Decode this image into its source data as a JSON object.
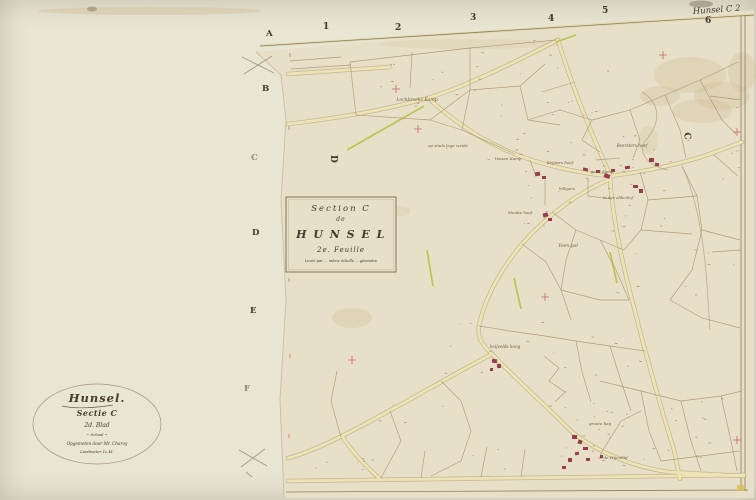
{
  "colors": {
    "paper_backing": "#e9e5d3",
    "paper_sheet": "#e7dfc8",
    "ink_dark": "#3f3629",
    "ink_brown": "#8a7554",
    "parcel_line": "#a6916a",
    "road_fill": "#ece3b6",
    "road_edge": "#b5a577",
    "hedge_green": "#b4bf3b",
    "building_red": "#8e2f44",
    "mark_red": "#c4544b",
    "stain": "#cdb98e"
  },
  "sheet": {
    "corner_label": "Hunsel C 2",
    "grid_numbers": [
      {
        "label": "1",
        "x": 323,
        "y": 29
      },
      {
        "label": "2",
        "x": 395,
        "y": 30
      },
      {
        "label": "3",
        "x": 470,
        "y": 20
      },
      {
        "label": "4",
        "x": 548,
        "y": 21
      },
      {
        "label": "5",
        "x": 602,
        "y": 13
      },
      {
        "label": "6",
        "x": 705,
        "y": 23
      }
    ],
    "row_letters": [
      {
        "label": "A",
        "x": 266,
        "y": 36,
        "o": 1
      },
      {
        "label": "B",
        "x": 262,
        "y": 91,
        "o": 1
      },
      {
        "label": "C",
        "x": 251,
        "y": 160,
        "o": 0.5
      },
      {
        "label": "D",
        "x": 252,
        "y": 235,
        "o": 1
      },
      {
        "label": "E",
        "x": 250,
        "y": 313,
        "o": 1
      },
      {
        "label": "F",
        "x": 244,
        "y": 391,
        "o": 0.55
      }
    ],
    "adjacent_letters": [
      {
        "label": "D",
        "x": 331,
        "y": 155,
        "rot": 90
      },
      {
        "label": "C",
        "x": 684,
        "y": 133,
        "rot": 80
      }
    ]
  },
  "cartouche": {
    "lines": [
      {
        "text": "Section C",
        "dy": 211,
        "size": 8.5,
        "style": "italic",
        "weight": "normal",
        "ls": 2
      },
      {
        "text": "de",
        "dy": 221,
        "size": 6,
        "style": "italic",
        "weight": "normal",
        "ls": 1
      },
      {
        "text": "H U N S E L",
        "dy": 238,
        "size": 11,
        "style": "normal",
        "weight": "bold",
        "ls": 1.5
      },
      {
        "text": "2e. Feuille",
        "dy": 252,
        "size": 7,
        "style": "italic",
        "weight": "normal",
        "ls": 1
      },
      {
        "text": "Levée par … même échelle … géomètre",
        "dy": 262,
        "size": 3.6,
        "style": "italic",
        "weight": "normal",
        "ls": 0
      }
    ]
  },
  "stamp": {
    "lines": [
      {
        "text": "Hunsel.",
        "dy": 402,
        "size": 11.5,
        "style": "italic",
        "weight": "bold",
        "ls": 1
      },
      {
        "text": "Sectie C",
        "dy": 416,
        "size": 8,
        "style": "italic",
        "weight": "bold",
        "ls": 0.5
      },
      {
        "text": "2d. Blad",
        "dy": 427,
        "size": 6,
        "style": "italic",
        "weight": "normal",
        "ls": 0
      },
      {
        "text": "~ Schaal ~",
        "dy": 436,
        "size": 3.8,
        "style": "italic",
        "weight": "normal",
        "ls": 0
      },
      {
        "text": "Opgemeten door Mr. Charoy",
        "dy": 445,
        "size": 4.2,
        "style": "italic",
        "weight": "normal",
        "ls": 0
      },
      {
        "text": "Landmeter 1e Kl.",
        "dy": 453,
        "size": 3.8,
        "style": "italic",
        "weight": "normal",
        "ls": 0
      }
    ]
  },
  "field_labels": [
    {
      "text": "Lochbroeks Kamp",
      "x": 417,
      "y": 101,
      "size": 4.5
    },
    {
      "text": "op stads lage weide",
      "x": 448,
      "y": 147,
      "size": 4
    },
    {
      "text": "Vossen Kamp",
      "x": 508,
      "y": 160,
      "size": 4
    },
    {
      "text": "Keijsers hoef",
      "x": 560,
      "y": 164,
      "size": 4
    },
    {
      "text": "hilligers",
      "x": 567,
      "y": 190,
      "size": 3.8
    },
    {
      "text": "Beersters hoef",
      "x": 632,
      "y": 147,
      "size": 4.2
    },
    {
      "text": "geert Kamp",
      "x": 602,
      "y": 173,
      "size": 3.8
    },
    {
      "text": "in den aldenhof",
      "x": 618,
      "y": 199,
      "size": 3.8
    },
    {
      "text": "Munke hoef",
      "x": 520,
      "y": 214,
      "size": 4
    },
    {
      "text": "Veen pol",
      "x": 568,
      "y": 247,
      "size": 4.5
    },
    {
      "text": "heijvelds hoog",
      "x": 505,
      "y": 348,
      "size": 4.2
    },
    {
      "text": "groote heg",
      "x": 600,
      "y": 425,
      "size": 4
    },
    {
      "text": "in de Wijenhof",
      "x": 613,
      "y": 459,
      "size": 4
    }
  ]
}
